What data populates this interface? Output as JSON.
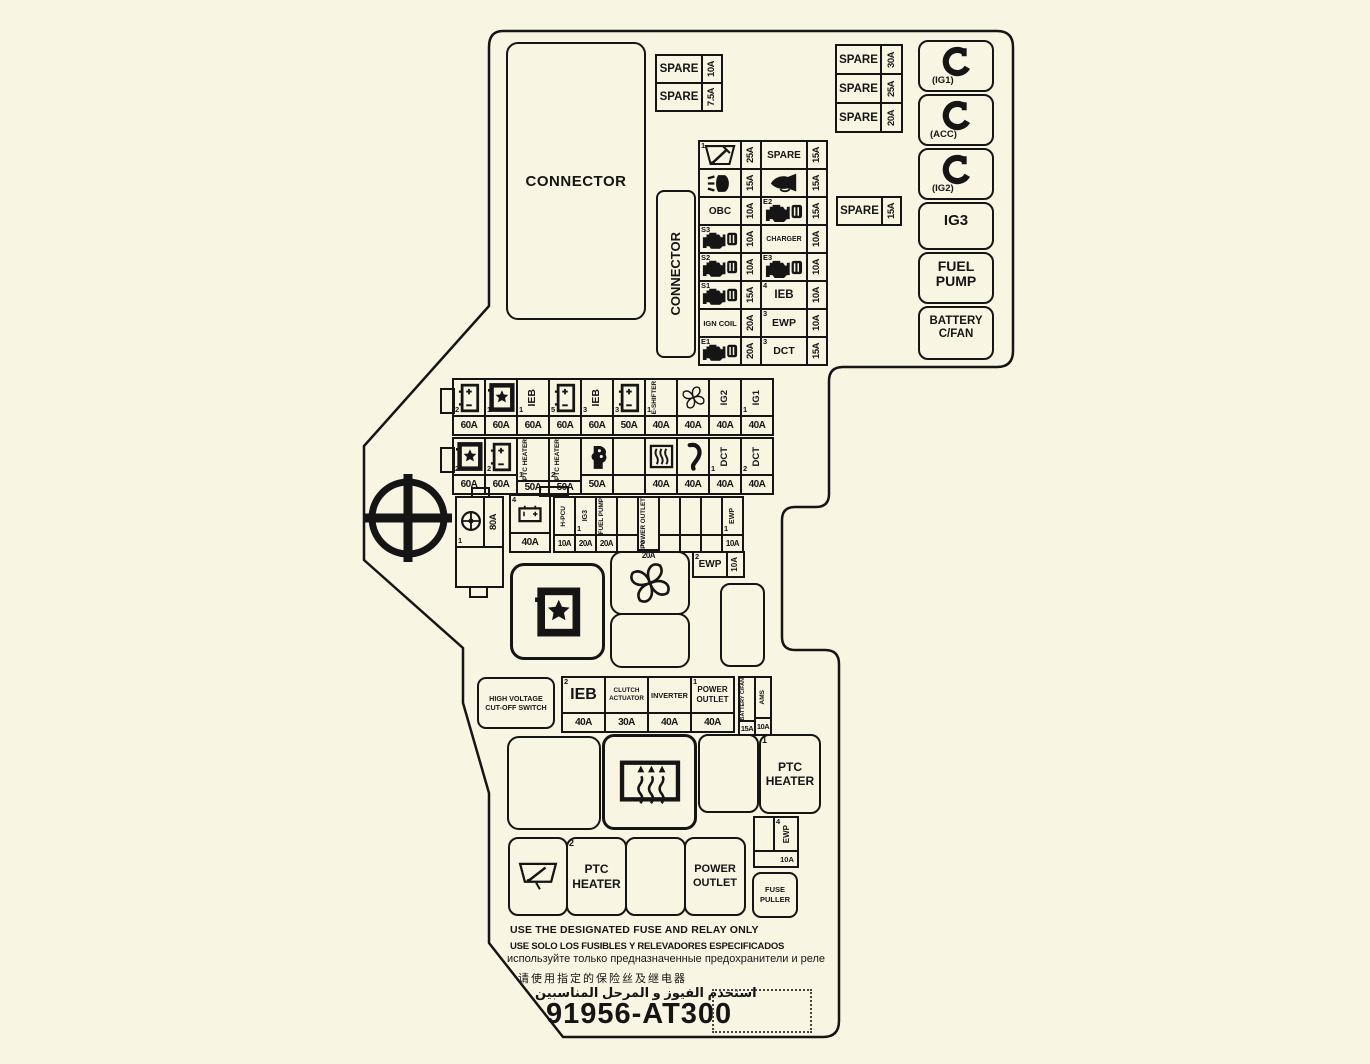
{
  "colors": {
    "bg": "#f8f5e3",
    "line": "#151515"
  },
  "connector_top": {
    "label": "CONNECTOR"
  },
  "connector_side": {
    "label": "CONNECTOR"
  },
  "top_left_spares": [
    {
      "label": "SPARE",
      "amp": "10A"
    },
    {
      "label": "SPARE",
      "amp": "7.5A"
    }
  ],
  "top_right_spares": [
    {
      "label": "SPARE",
      "amp": "30A"
    },
    {
      "label": "SPARE",
      "amp": "25A"
    },
    {
      "label": "SPARE",
      "amp": "20A"
    }
  ],
  "mid_spare": {
    "label": "SPARE",
    "amp": "15A"
  },
  "right_column": [
    {
      "icon": "key-icon",
      "caption": "(IG1)"
    },
    {
      "icon": "key-icon",
      "caption": "(ACC)"
    },
    {
      "icon": "key-icon",
      "caption": "(IG2)"
    },
    {
      "label": "IG3"
    },
    {
      "line1": "FUEL",
      "line2": "PUMP"
    },
    {
      "line1": "BATTERY",
      "line2": "C/FAN"
    }
  ],
  "center_grid": {
    "rows": [
      {
        "c1": {
          "sup": "1",
          "icon": "wiper-icon"
        },
        "a1": "25A",
        "c2": {
          "label": "SPARE"
        },
        "a2": "15A"
      },
      {
        "c1": {
          "icon": "headlight-icon"
        },
        "a1": "15A",
        "c2": {
          "icon": "horn-icon"
        },
        "a2": "15A"
      },
      {
        "c1": {
          "label": "OBC"
        },
        "a1": "10A",
        "c2": {
          "sup": "E2",
          "icon": "engine-icon"
        },
        "a2": "15A"
      },
      {
        "c1": {
          "sup": "S3",
          "icon": "engine-icon"
        },
        "a1": "10A",
        "c2": {
          "label": "CHARGER"
        },
        "a2": "10A"
      },
      {
        "c1": {
          "sup": "S2",
          "icon": "engine-icon"
        },
        "a1": "10A",
        "c2": {
          "sup": "E3",
          "icon": "engine-icon"
        },
        "a2": "10A"
      },
      {
        "c1": {
          "sup": "S1",
          "icon": "engine-icon"
        },
        "a1": "15A",
        "c2": {
          "sup": "4",
          "label": "IEB"
        },
        "a2": "10A"
      },
      {
        "c1": {
          "label": "IGN COIL"
        },
        "a1": "20A",
        "c2": {
          "sup": "3",
          "label": "EWP"
        },
        "a2": "10A"
      },
      {
        "c1": {
          "sup": "E1",
          "icon": "engine-icon"
        },
        "a1": "20A",
        "c2": {
          "sup": "3",
          "label": "DCT"
        },
        "a2": "15A"
      }
    ]
  },
  "fuse_row1": [
    {
      "icon": "battery-icon",
      "sub": "2",
      "amp": "60A"
    },
    {
      "icon": "battery-star-icon",
      "sub": "1",
      "amp": "60A"
    },
    {
      "label": "IEB",
      "sub": "1",
      "amp": "60A"
    },
    {
      "icon": "battery-icon",
      "sub": "5",
      "amp": "60A"
    },
    {
      "label": "IEB",
      "sub": "3",
      "amp": "60A"
    },
    {
      "icon": "battery-icon",
      "sub": "3",
      "amp": "50A"
    },
    {
      "label": "E-SHIFTER",
      "sub": "1",
      "amp": "40A"
    },
    {
      "icon": "fan-icon",
      "amp": "40A"
    },
    {
      "label": "IG2",
      "amp": "40A"
    },
    {
      "label": "IG1",
      "sub": "1",
      "amp": "40A"
    }
  ],
  "fuse_row2": [
    {
      "icon": "battery-star-icon",
      "sub": "2",
      "amp": "60A"
    },
    {
      "icon": "battery-icon",
      "sub": "2",
      "amp": "60A"
    },
    {
      "label": "PTC HEATER",
      "sub": "1",
      "amp": "50A"
    },
    {
      "label": "PTC HEATER",
      "sub": "2",
      "amp": "50A"
    },
    {
      "icon": "blower-icon",
      "amp": "50A"
    },
    {},
    {
      "icon": "defroster-icon",
      "amp": "40A"
    },
    {
      "icon": "hose-icon",
      "amp": "40A"
    },
    {
      "label": "DCT",
      "sub": "1",
      "amp": "40A"
    },
    {
      "label": "DCT",
      "sub": "2",
      "amp": "40A"
    }
  ],
  "fuse_row3": [
    {
      "label": "H-PCU",
      "amp": "10A"
    },
    {
      "label": "IG3",
      "sub": "1",
      "amp": "20A"
    },
    {
      "label": "FUEL PUMP",
      "amp": "20A"
    },
    {},
    {
      "label": "POWER OUTLET",
      "sub": "2",
      "amp": "20A"
    },
    {},
    {},
    {},
    {
      "label": "EWP",
      "sub": "1",
      "amp": "10A"
    }
  ],
  "battery4_fuse": {
    "sup": "4",
    "icon": "battery-icon",
    "amp": "40A"
  },
  "steering_fuse": {
    "sub": "1",
    "icon": "steering-circle-icon",
    "amp": "80A"
  },
  "ewp2_fuse": {
    "sup": "2",
    "label": "EWP",
    "amp": "10A"
  },
  "ewp4_fuse": {
    "sup": "4",
    "label": "EWP",
    "amp": "10A"
  },
  "fuse_puller": {
    "line1": "FUSE",
    "line2": "PULLER"
  },
  "hv_switch": {
    "line1": "HIGH VOLTAGE",
    "line2": "CUT-OFF SWITCH"
  },
  "hv_fuses": [
    {
      "sup": "2",
      "label": "IEB",
      "amp": "40A"
    },
    {
      "label": "CLUTCH ACTUATOR",
      "amp": "30A"
    },
    {
      "label": "INVERTER",
      "amp": "40A"
    },
    {
      "sup": "1",
      "label": "POWER OUTLET",
      "amp": "40A"
    }
  ],
  "hv_pair": [
    {
      "label": "BATTERY C/FAN",
      "amp": "15A"
    },
    {
      "label": "AMS",
      "amp": "10A"
    }
  ],
  "bottom_relays": {
    "ptc1": {
      "sup": "1",
      "line1": "PTC",
      "line2": "HEATER"
    },
    "ptc2": {
      "sup": "2",
      "line1": "PTC",
      "line2": "HEATER"
    },
    "power_outlet": {
      "line1": "POWER",
      "line2": "OUTLET"
    }
  },
  "notes": [
    "USE THE DESIGNATED FUSE AND RELAY ONLY",
    "USE SOLO LOS FUSIBLES Y RELEVADORES ESPECIFICADOS",
    "используйте только предназначенные предохранители и реле",
    "请使用指定的保险丝及继电器",
    "استخدم الفيوز و المرحل المناسبين"
  ],
  "part_number": "91956-AT300"
}
